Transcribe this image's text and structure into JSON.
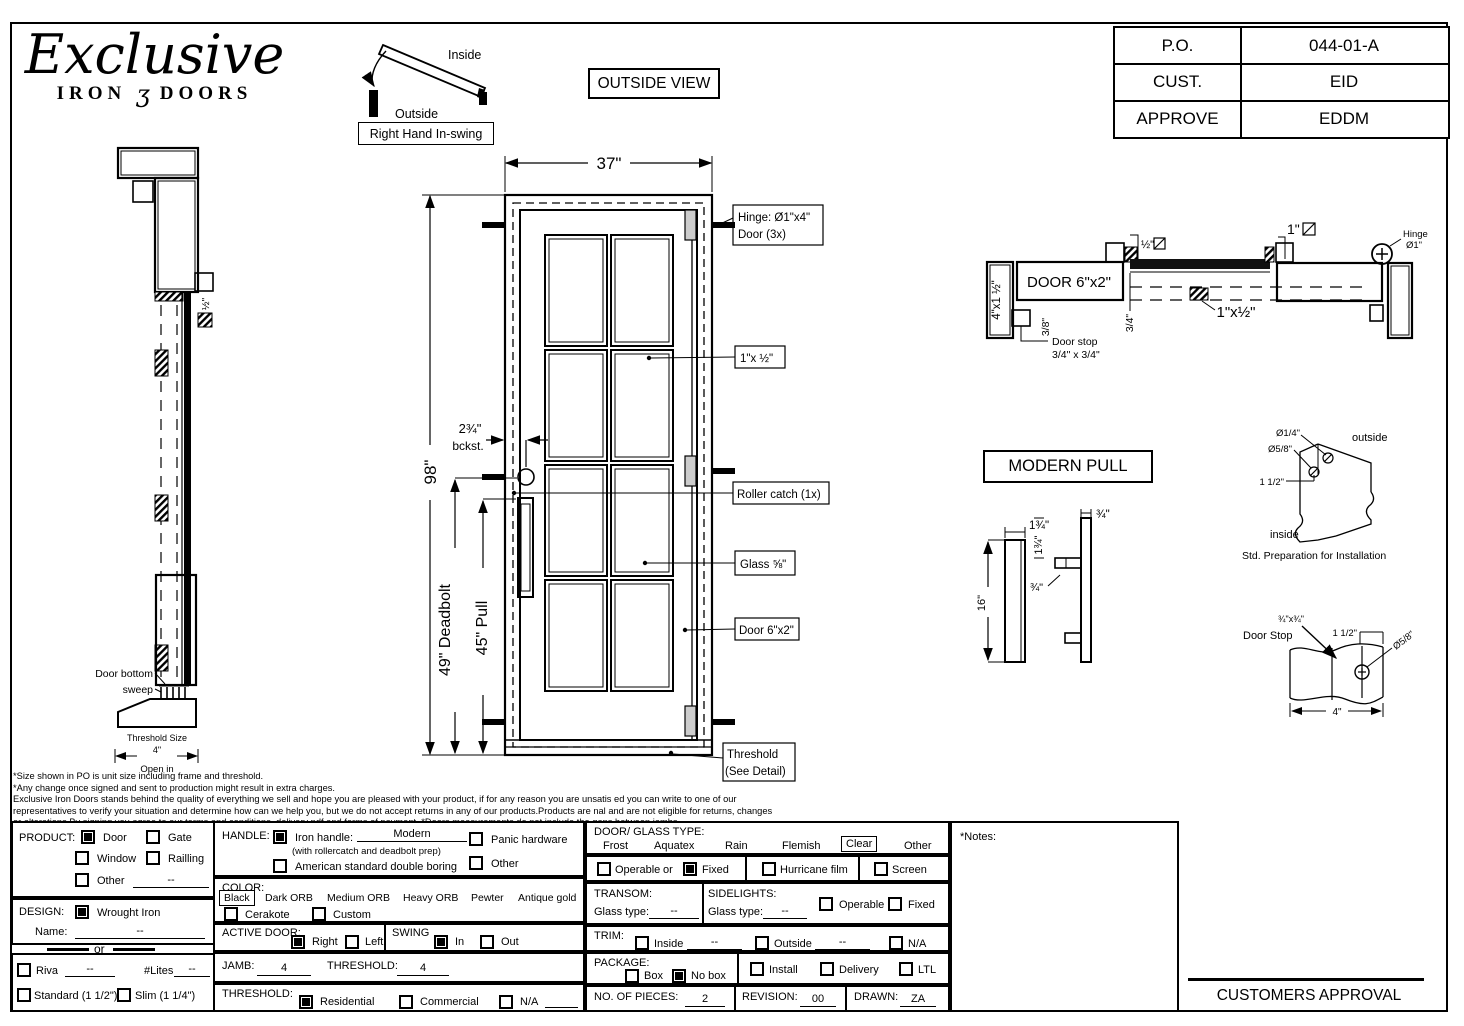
{
  "logo": {
    "script": "Exclusive",
    "iron": "IRON",
    "ornament": "ʒ",
    "doors": "DOORS"
  },
  "po_table": {
    "r1_label": "P.O.",
    "r1_value": "044-01-A",
    "r2_label": "CUST.",
    "r2_value": "EID",
    "r3_label": "APPROVE",
    "r3_value": "EDDM"
  },
  "swing_diagram": {
    "inside": "Inside",
    "outside": "Outside",
    "caption": "Right Hand In-swing"
  },
  "outside_view_label": "OUTSIDE VIEW",
  "elevation": {
    "dim_width": "37\"",
    "dim_height": "98\"",
    "dim_deadbolt": "49\" Deadbolt",
    "dim_pull": "45\" Pull",
    "backset": "2¾\"",
    "backset_label": "bckst.",
    "hinge_line1": "Hinge: Ø1\"x4\"",
    "hinge_line2": "Door (3x)",
    "bar_callout": "1\"x ½\"",
    "roller_callout": "Roller catch  (1x)",
    "glass_callout": "Glass ⅝\"",
    "door_callout": "Door 6\"x2\"",
    "threshold_line1": "Threshold",
    "threshold_line2": "(See Detail)"
  },
  "side_view": {
    "half_dim": "½\"",
    "sweep_line1": "Door bottom",
    "sweep_line2": "sweep",
    "threshold_size": "Threshold Size",
    "four": "4\"",
    "open_in": "Open in"
  },
  "plan_section": {
    "jamb_left": "4\"x1 ½\"",
    "door_label": "DOOR 6\"x2\"",
    "half": "½\"",
    "one": "1\"",
    "bar": "1\"x½\"",
    "d38": "3/8\"",
    "d34": "3/4\"",
    "hinge_line1": "Hinge",
    "hinge_line2": "Ø1\"",
    "stop_line1": "Door stop",
    "stop_line2": "3/4\" x 3/4\""
  },
  "modern_pull": {
    "title": "MODERN PULL",
    "w_left": "1¾\"",
    "w_right": "¾\"",
    "arm_offset": "1¾\"",
    "arm_gap": "¾\"",
    "height": "16\""
  },
  "prep_detail": {
    "d14": "Ø1/4\"",
    "d58": "Ø5/8\"",
    "d112": "1 1/2\"",
    "outside": "outside",
    "inside": "inside",
    "caption": "Std. Preparation for Installation"
  },
  "stop_detail": {
    "size": "¾\"x¾\"",
    "label": "Door Stop",
    "d112": "1 1/2\"",
    "d58": "Ø5/8\"",
    "width": "4\""
  },
  "disclaimer": {
    "l1": "*Size shown in PO is unit size including frame and threshold.",
    "l2": "*Any change once signed and sent to production might result in extra charges.",
    "l3": "Exclusive Iron Doors stands behind the quality of everything we sell and hope you are pleased with your product, if for any reason you are unsatis   ed you can write to one of our",
    "l4": "representatives to verify your situation and determine how can we help you, but we do not accept returns in any of our products.Products are    nal and are not eligible for returns, changes",
    "l5": "or alterations.By signing you agree to our terms and conditions, delivery pdf and forms of payment. *Doors measurements do not include the gaps between jambs"
  },
  "form": {
    "product": {
      "label": "PRODUCT:",
      "door": "Door",
      "gate": "Gate",
      "window": "Window",
      "railling": "Railling",
      "other": "Other",
      "other_value": "--"
    },
    "design": {
      "label": "DESIGN:",
      "wrought_iron": "Wrought Iron",
      "name_label": "Name:",
      "name_value": "--"
    },
    "or_divider": "or",
    "riva": {
      "label": "Riva",
      "value": "--",
      "lites_label": "#Lites",
      "lites_value": "--"
    },
    "thickness": {
      "standard": "Standard (1 1/2\")",
      "slim": "Slim (1 1/4\")"
    },
    "handle": {
      "label": "HANDLE:",
      "iron": "Iron handle:",
      "iron_value": "Modern",
      "iron_note": "(with rollercatch and deadbolt prep)",
      "american": "American standard double boring",
      "panic": "Panic hardware",
      "other": "Other"
    },
    "color": {
      "label": "COLOR:",
      "black": "Black",
      "dark_orb": "Dark ORB",
      "medium_orb": "Medium ORB",
      "heavy_orb": "Heavy ORB",
      "pewter": "Pewter",
      "antique_gold": "Antique gold",
      "cerakote": "Cerakote",
      "custom": "Custom"
    },
    "active_door": {
      "label": "ACTIVE DOOR:",
      "right": "Right",
      "left": "Left"
    },
    "swing": {
      "label": "SWING",
      "in": "In",
      "out": "Out"
    },
    "jamb": {
      "label": "JAMB:",
      "value": "4"
    },
    "threshold_dim": {
      "label": "THRESHOLD:",
      "value": "4"
    },
    "threshold": {
      "label": "THRESHOLD:",
      "residential": "Residential",
      "commercial": "Commercial",
      "na": "N/A"
    },
    "glass_type": {
      "label": "DOOR/ GLASS TYPE:",
      "frost": "Frost",
      "aquatex": "Aquatex",
      "rain": "Rain",
      "flemish": "Flemish",
      "clear": "Clear",
      "other": "Other"
    },
    "fit": {
      "operable": "Operable",
      "or": "or",
      "fixed": "Fixed",
      "hurricane": "Hurricane film",
      "screen": "Screen"
    },
    "transom": {
      "label": "TRANSOM:",
      "glass_label": "Glass type:",
      "value": "--"
    },
    "sidelights": {
      "label": "SIDELIGHTS:",
      "glass_label": "Glass type:",
      "value": "--",
      "operable": "Operable",
      "fixed": "Fixed"
    },
    "trim": {
      "label": "TRIM:",
      "inside": "Inside",
      "inside_value": "--",
      "outside": "Outside",
      "outside_value": "--",
      "na": "N/A"
    },
    "package": {
      "label": "PACKAGE:",
      "box": "Box",
      "no_box": "No box",
      "install": "Install",
      "delivery": "Delivery",
      "ltl": "LTL"
    },
    "pieces": {
      "label": "NO. OF  PIECES:",
      "value": "2"
    },
    "revision": {
      "label": "REVISION:",
      "value": "00"
    },
    "drawn": {
      "label": "DRAWN:",
      "value": "ZA"
    },
    "notes_label": "*Notes:",
    "approval": "CUSTOMERS APPROVAL"
  }
}
